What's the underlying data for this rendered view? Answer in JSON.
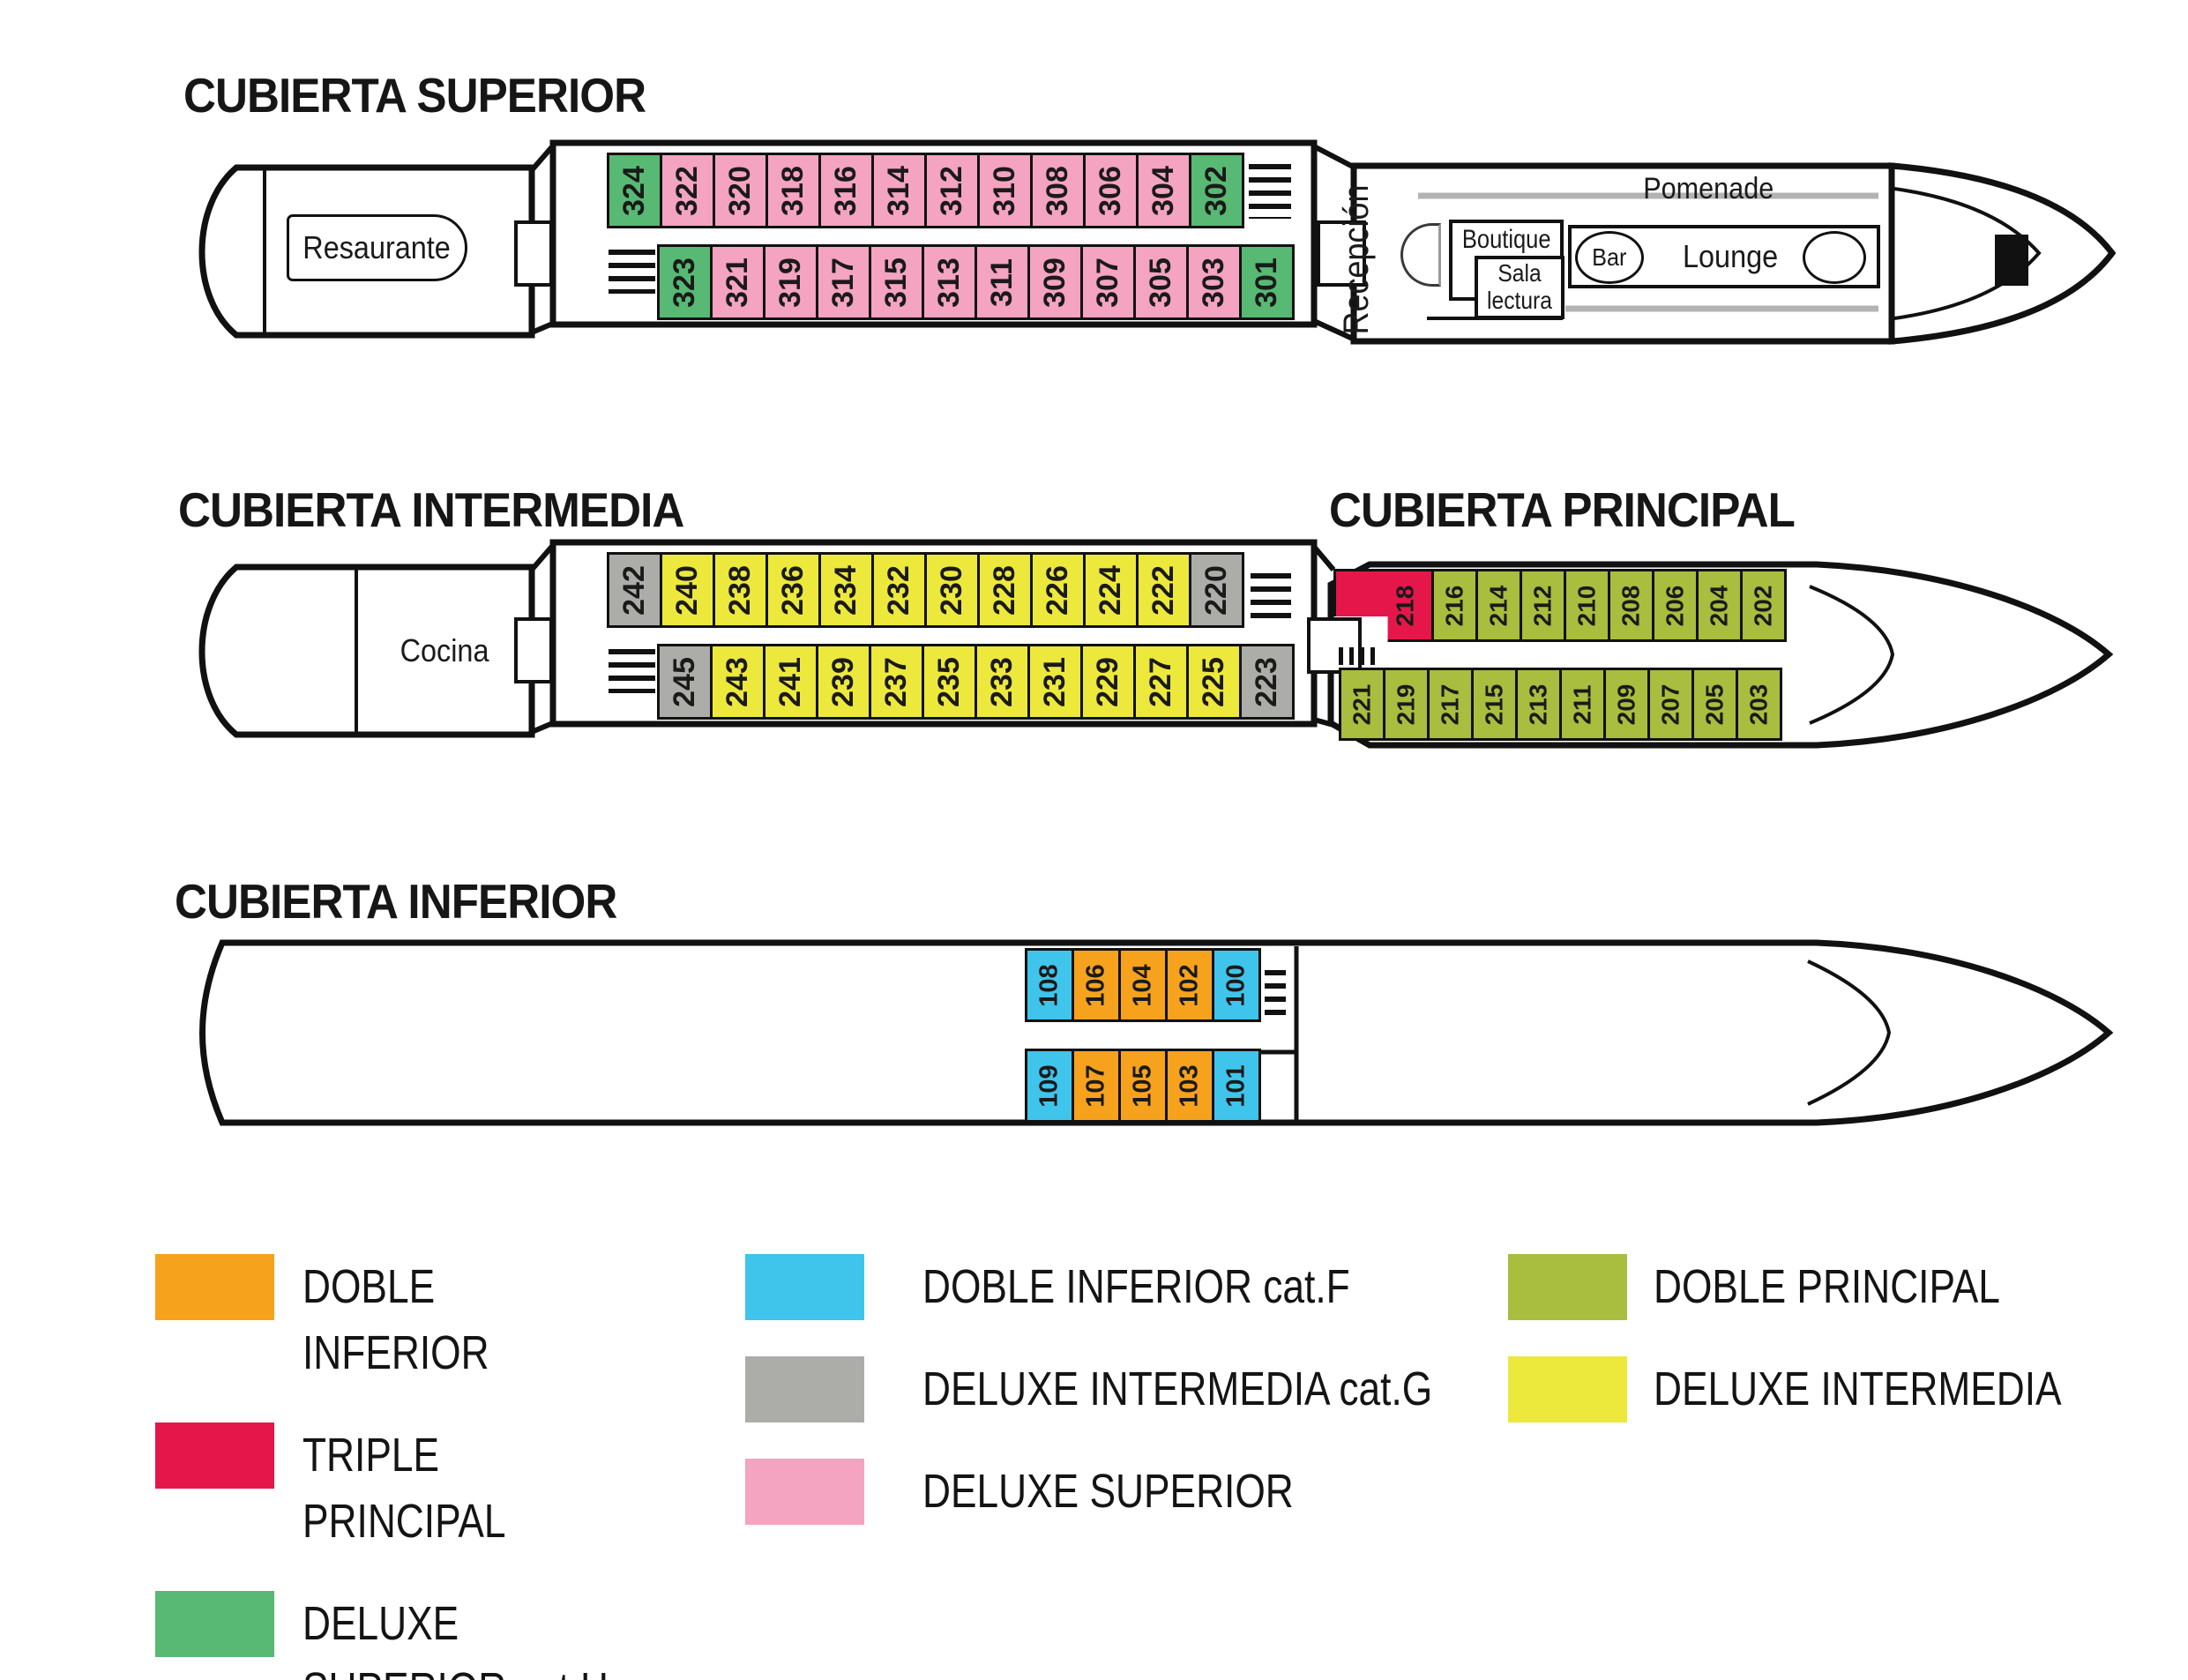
{
  "colors": {
    "doble_inferior": "#F6A21D",
    "triple_principal": "#E5174A",
    "deluxe_superior_h": "#57B973",
    "doble_inferior_f": "#3FC4EB",
    "deluxe_intermedia_g": "#ACADA8",
    "deluxe_superior": "#F4A3C0",
    "doble_principal": "#A9BD3E",
    "deluxe_intermedia": "#EDE83C",
    "outline": "#111111"
  },
  "decks": {
    "superior": {
      "title": "CUBIERTA SUPERIOR",
      "restaurant_label": "Resaurante",
      "bow": {
        "reception": "Recepción",
        "promenade": "Pomenade",
        "boutique": "Boutique",
        "reading_room": "Sala lectura",
        "bar": "Bar",
        "lounge": "Lounge"
      },
      "cabin_rows": {
        "port": [
          {
            "n": "324",
            "c": "deluxe_superior_h"
          },
          {
            "n": "322",
            "c": "deluxe_superior"
          },
          {
            "n": "320",
            "c": "deluxe_superior"
          },
          {
            "n": "318",
            "c": "deluxe_superior"
          },
          {
            "n": "316",
            "c": "deluxe_superior"
          },
          {
            "n": "314",
            "c": "deluxe_superior"
          },
          {
            "n": "312",
            "c": "deluxe_superior"
          },
          {
            "n": "310",
            "c": "deluxe_superior"
          },
          {
            "n": "308",
            "c": "deluxe_superior"
          },
          {
            "n": "306",
            "c": "deluxe_superior"
          },
          {
            "n": "304",
            "c": "deluxe_superior"
          },
          {
            "n": "302",
            "c": "deluxe_superior_h"
          }
        ],
        "starboard": [
          {
            "n": "323",
            "c": "deluxe_superior_h"
          },
          {
            "n": "321",
            "c": "deluxe_superior"
          },
          {
            "n": "319",
            "c": "deluxe_superior"
          },
          {
            "n": "317",
            "c": "deluxe_superior"
          },
          {
            "n": "315",
            "c": "deluxe_superior"
          },
          {
            "n": "313",
            "c": "deluxe_superior"
          },
          {
            "n": "311",
            "c": "deluxe_superior"
          },
          {
            "n": "309",
            "c": "deluxe_superior"
          },
          {
            "n": "307",
            "c": "deluxe_superior"
          },
          {
            "n": "305",
            "c": "deluxe_superior"
          },
          {
            "n": "303",
            "c": "deluxe_superior"
          },
          {
            "n": "301",
            "c": "deluxe_superior_h"
          }
        ]
      }
    },
    "intermedia": {
      "title": "CUBIERTA INTERMEDIA",
      "kitchen_label": "Cocina",
      "cabin_rows": {
        "port": [
          {
            "n": "242",
            "c": "deluxe_intermedia_g"
          },
          {
            "n": "240",
            "c": "deluxe_intermedia"
          },
          {
            "n": "238",
            "c": "deluxe_intermedia"
          },
          {
            "n": "236",
            "c": "deluxe_intermedia"
          },
          {
            "n": "234",
            "c": "deluxe_intermedia"
          },
          {
            "n": "232",
            "c": "deluxe_intermedia"
          },
          {
            "n": "230",
            "c": "deluxe_intermedia"
          },
          {
            "n": "228",
            "c": "deluxe_intermedia"
          },
          {
            "n": "226",
            "c": "deluxe_intermedia"
          },
          {
            "n": "224",
            "c": "deluxe_intermedia"
          },
          {
            "n": "222",
            "c": "deluxe_intermedia"
          },
          {
            "n": "220",
            "c": "deluxe_intermedia_g"
          }
        ],
        "starboard": [
          {
            "n": "245",
            "c": "deluxe_intermedia_g"
          },
          {
            "n": "243",
            "c": "deluxe_intermedia"
          },
          {
            "n": "241",
            "c": "deluxe_intermedia"
          },
          {
            "n": "239",
            "c": "deluxe_intermedia"
          },
          {
            "n": "237",
            "c": "deluxe_intermedia"
          },
          {
            "n": "235",
            "c": "deluxe_intermedia"
          },
          {
            "n": "233",
            "c": "deluxe_intermedia"
          },
          {
            "n": "231",
            "c": "deluxe_intermedia"
          },
          {
            "n": "229",
            "c": "deluxe_intermedia"
          },
          {
            "n": "227",
            "c": "deluxe_intermedia"
          },
          {
            "n": "225",
            "c": "deluxe_intermedia"
          },
          {
            "n": "223",
            "c": "deluxe_intermedia_g"
          }
        ]
      }
    },
    "principal": {
      "title": "CUBIERTA PRINCIPAL",
      "cabin_rows": {
        "port": [
          {
            "n": "218",
            "c": "triple_principal",
            "cls": "cabin-218"
          },
          {
            "n": "216",
            "c": "doble_principal"
          },
          {
            "n": "214",
            "c": "doble_principal"
          },
          {
            "n": "212",
            "c": "doble_principal"
          },
          {
            "n": "210",
            "c": "doble_principal"
          },
          {
            "n": "208",
            "c": "doble_principal"
          },
          {
            "n": "206",
            "c": "doble_principal"
          },
          {
            "n": "204",
            "c": "doble_principal"
          },
          {
            "n": "202",
            "c": "doble_principal"
          }
        ],
        "starboard": [
          {
            "n": "221",
            "c": "doble_principal"
          },
          {
            "n": "219",
            "c": "doble_principal"
          },
          {
            "n": "217",
            "c": "doble_principal"
          },
          {
            "n": "215",
            "c": "doble_principal"
          },
          {
            "n": "213",
            "c": "doble_principal"
          },
          {
            "n": "211",
            "c": "doble_principal"
          },
          {
            "n": "209",
            "c": "doble_principal"
          },
          {
            "n": "207",
            "c": "doble_principal"
          },
          {
            "n": "205",
            "c": "doble_principal"
          },
          {
            "n": "203",
            "c": "doble_principal"
          }
        ]
      }
    },
    "inferior": {
      "title": "CUBIERTA INFERIOR",
      "cabin_rows": {
        "port": [
          {
            "n": "108",
            "c": "doble_inferior_f"
          },
          {
            "n": "106",
            "c": "doble_inferior"
          },
          {
            "n": "104",
            "c": "doble_inferior"
          },
          {
            "n": "102",
            "c": "doble_inferior"
          },
          {
            "n": "100",
            "c": "doble_inferior_f"
          }
        ],
        "starboard": [
          {
            "n": "109",
            "c": "doble_inferior_f"
          },
          {
            "n": "107",
            "c": "doble_inferior"
          },
          {
            "n": "105",
            "c": "doble_inferior"
          },
          {
            "n": "103",
            "c": "doble_inferior"
          },
          {
            "n": "101",
            "c": "doble_inferior_f"
          }
        ]
      }
    }
  },
  "legend": {
    "items": [
      {
        "label": "DOBLE INFERIOR",
        "color_key": "doble_inferior"
      },
      {
        "label": "TRIPLE PRINCIPAL",
        "color_key": "triple_principal"
      },
      {
        "label": "DELUXE SUPERIOR cat.H",
        "color_key": "deluxe_superior_h"
      },
      {
        "label": "DOBLE INFERIOR cat.F",
        "color_key": "doble_inferior_f"
      },
      {
        "label": "DELUXE INTERMEDIA cat.G",
        "color_key": "deluxe_intermedia_g"
      },
      {
        "label": "DELUXE SUPERIOR",
        "color_key": "deluxe_superior"
      },
      {
        "label": "DOBLE PRINCIPAL",
        "color_key": "doble_principal"
      },
      {
        "label": "DELUXE INTERMEDIA",
        "color_key": "deluxe_intermedia"
      }
    ]
  }
}
